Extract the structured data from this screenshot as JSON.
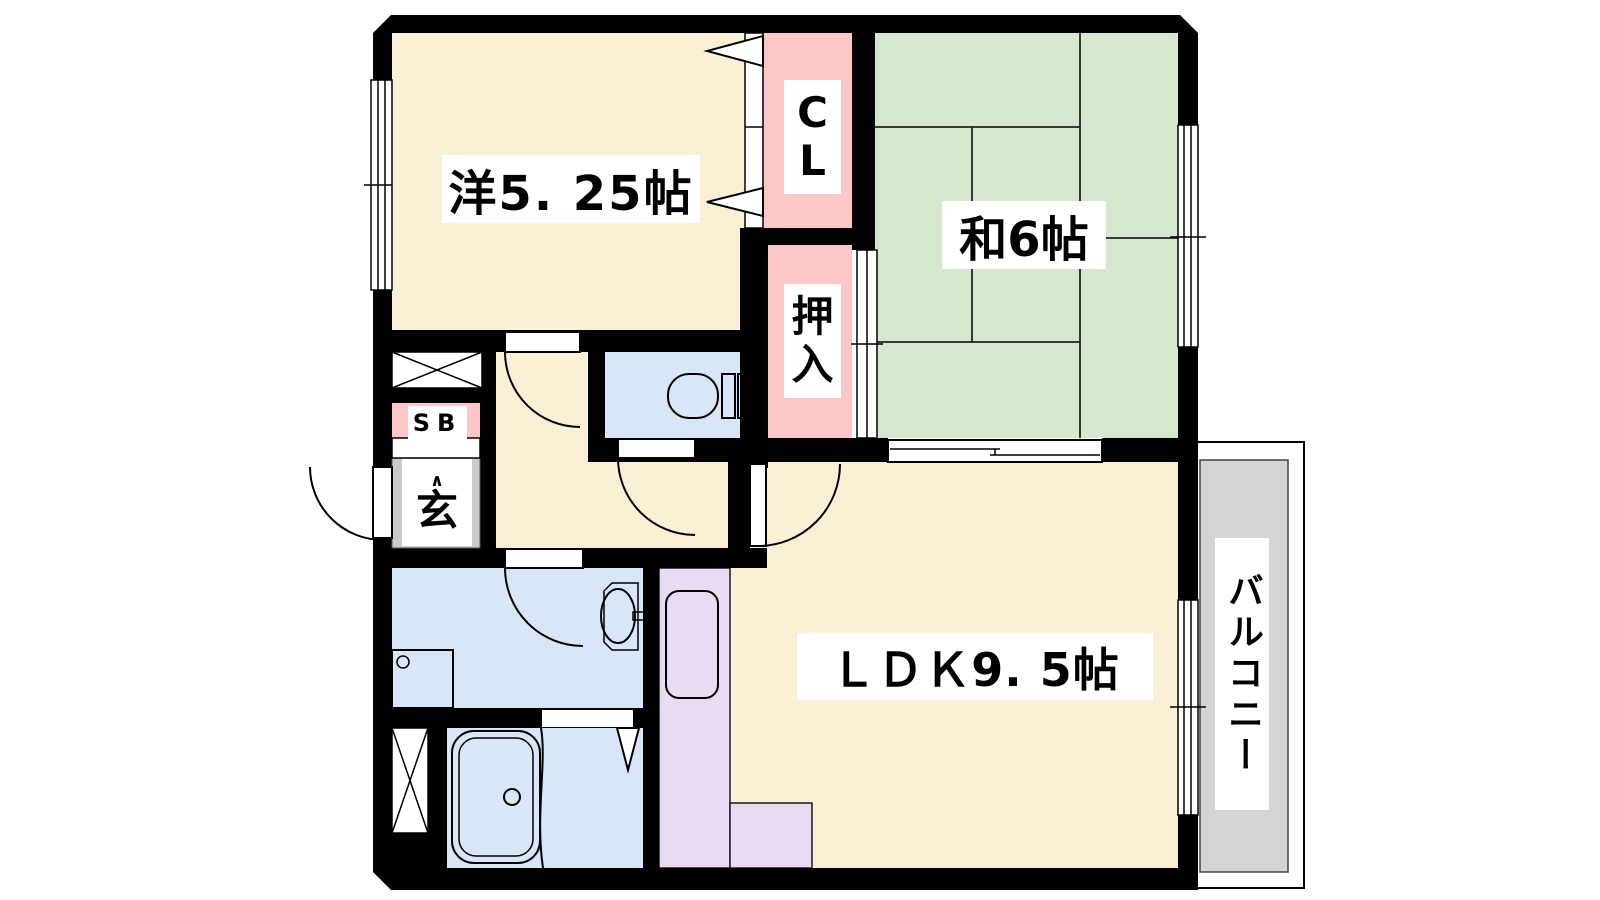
{
  "labels": {
    "western_room": "洋5. 25帖",
    "japanese_room": "和6帖",
    "ldk": "ＬＤＫ9. 5帖",
    "closet_line1": "C",
    "closet_line2": "L",
    "oshiire_line1": "押",
    "oshiire_line2": "入",
    "balcony": "バルコニー",
    "shoe_box": "SB",
    "entrance": "玄",
    "entrance_arrow": "∧"
  },
  "colors": {
    "room-cream": "#FAF0D6",
    "tatami-green": "#D6E7CF",
    "closet-pink": "#FBC7C9",
    "wet-blue": "#D8E6F8",
    "kitchen-lavender": "#E7DCF2",
    "genkan-gray": "#CBCBCB",
    "balcony-gray": "#D4D4D4",
    "wall-black": "#000000"
  }
}
